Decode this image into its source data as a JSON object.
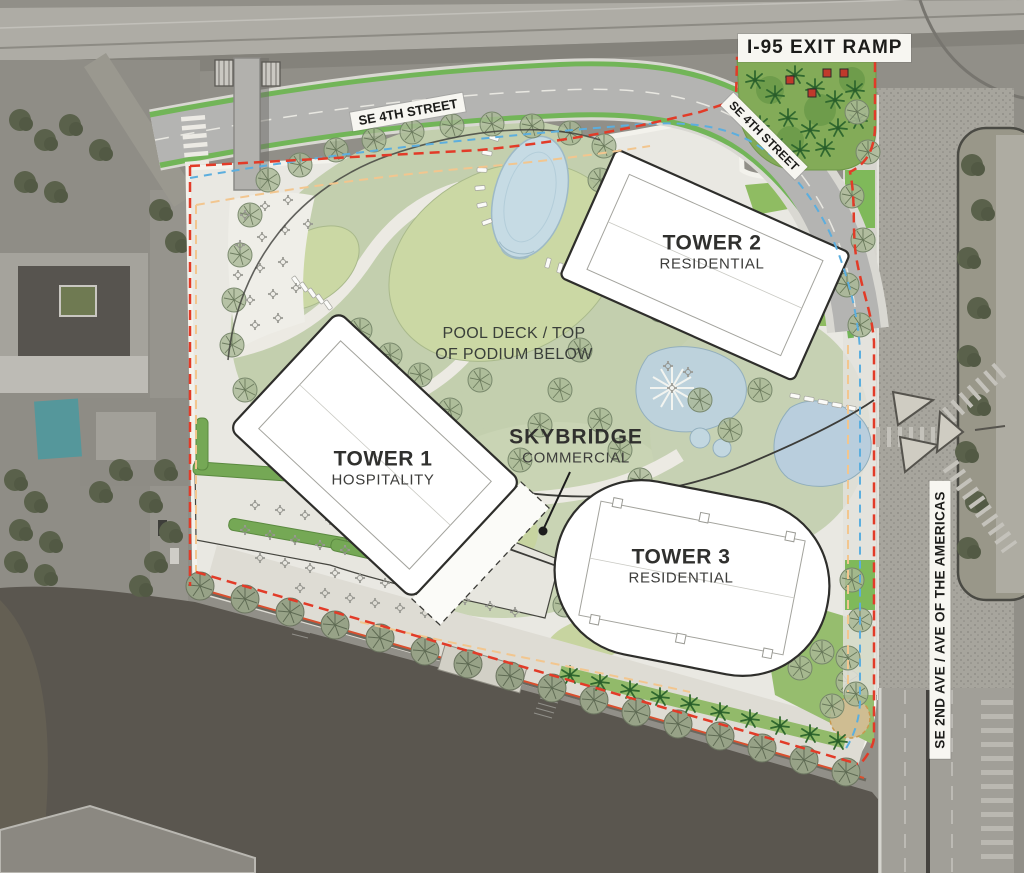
{
  "streets": {
    "i95_exit_ramp": "I-95 EXIT RAMP",
    "se_4th_street_top": "SE 4TH STREET",
    "se_4th_street_east": "SE 4TH STREET",
    "se_2nd_ave": "SE 2ND AVE / AVE OF THE AMERICAS"
  },
  "areas": {
    "pool_deck_line1": "POOL DECK / TOP",
    "pool_deck_line2": "OF PODIUM BELOW"
  },
  "towers": [
    {
      "name": "TOWER 1",
      "program": "HOSPITALITY"
    },
    {
      "name": "TOWER 2",
      "program": "RESIDENTIAL"
    },
    {
      "name": "TOWER 3",
      "program": "RESIDENTIAL"
    }
  ],
  "skybridge": {
    "name": "SKYBRIDGE",
    "program": "COMMERCIAL"
  },
  "colors": {
    "boundary_red": "#e23b28",
    "easement_blue": "#5caede",
    "setback_orange": "#f2c68f",
    "bike_lane_green": "#72b558",
    "park_green": "#83ab58",
    "lawn_green": "#cbd8a4",
    "pool_blue": "#c6dbe4",
    "water_gray": "#5a564f"
  }
}
